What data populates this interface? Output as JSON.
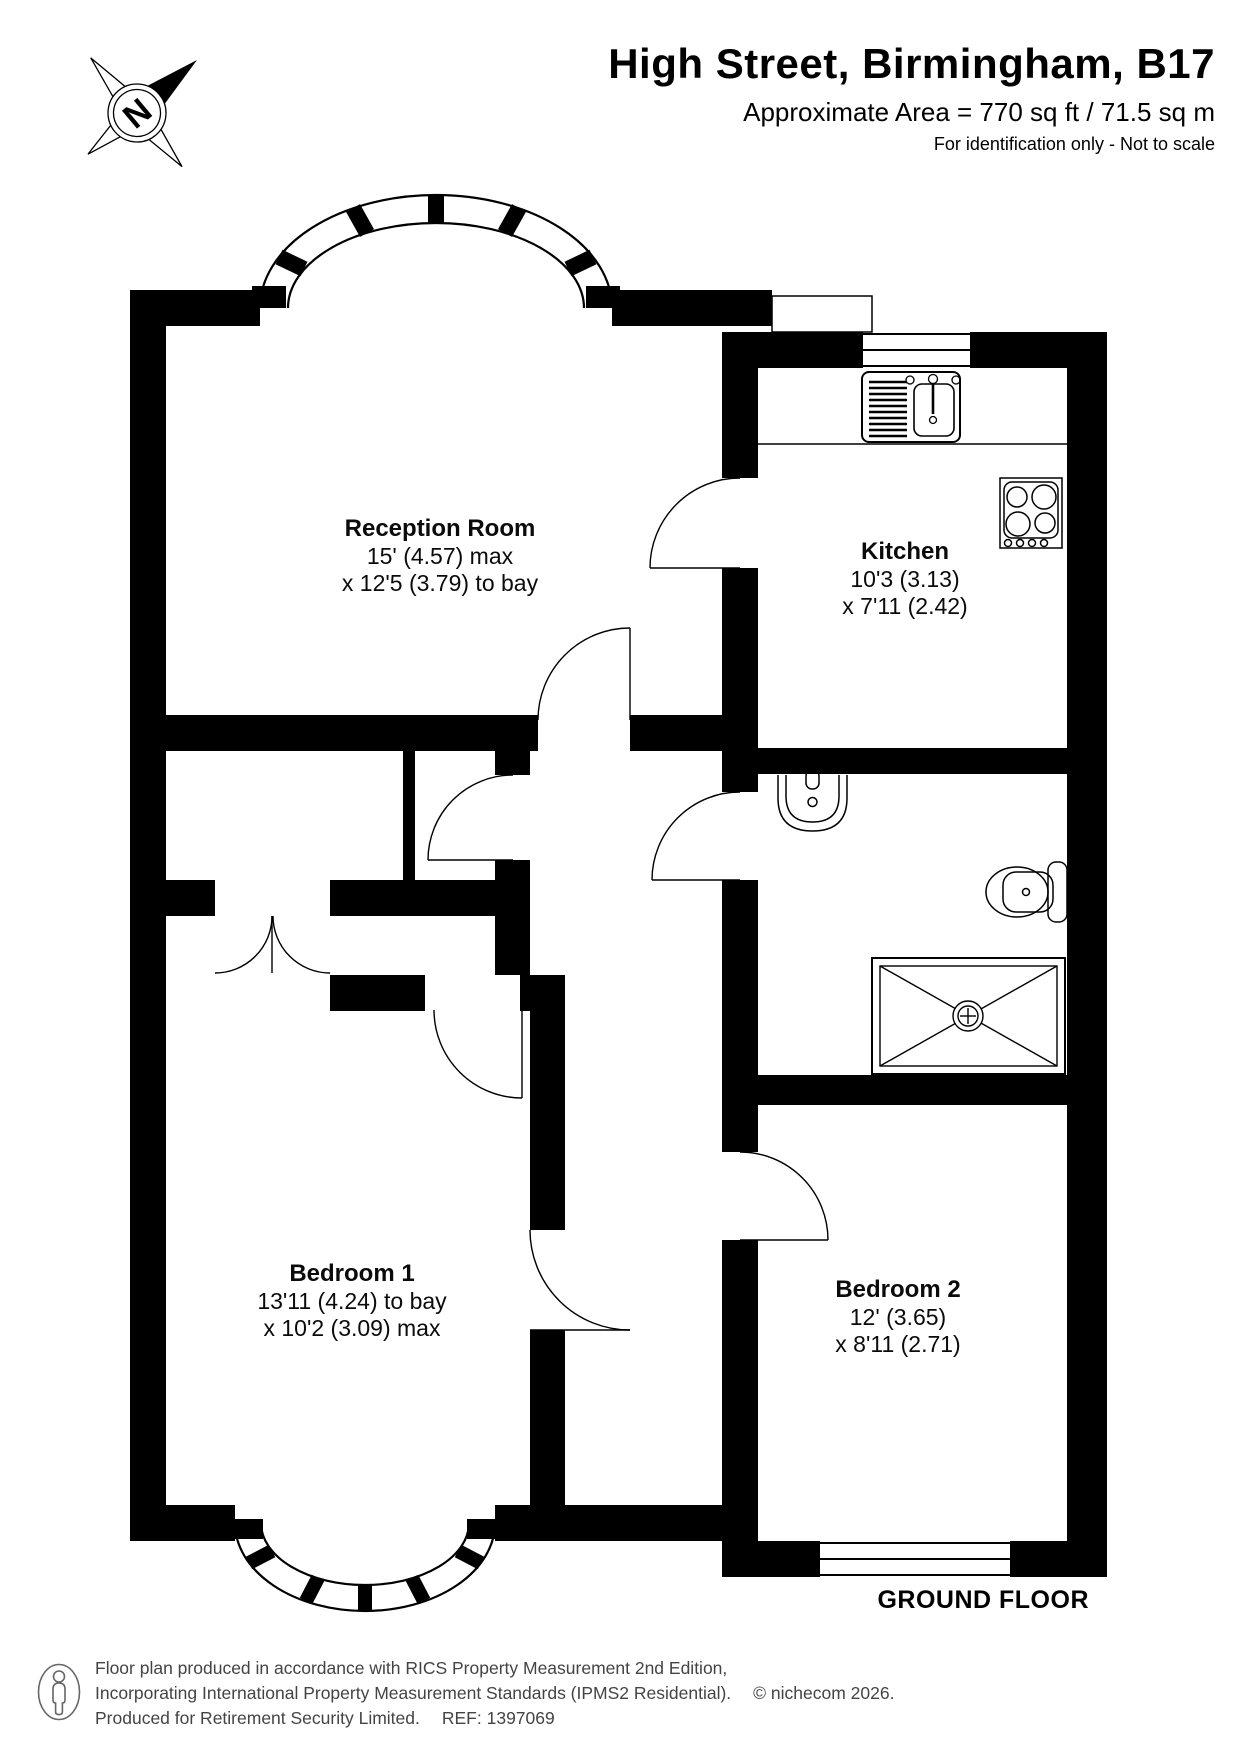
{
  "header": {
    "title": "High Street, Birmingham, B17",
    "subtitle": "Approximate Area = 770 sq ft / 71.5 sq m",
    "disclaimer": "For identification only - Not to scale"
  },
  "compass": {
    "north_label": "N"
  },
  "rooms": {
    "reception": {
      "name": "Reception Room",
      "dim1": "15' (4.57) max",
      "dim2": "x 12'5 (3.79) to bay"
    },
    "kitchen": {
      "name": "Kitchen",
      "dim1": "10'3 (3.13)",
      "dim2": "x 7'11 (2.42)"
    },
    "bedroom1": {
      "name": "Bedroom 1",
      "dim1": "13'11 (4.24) to bay",
      "dim2": "x 10'2 (3.09) max"
    },
    "bedroom2": {
      "name": "Bedroom 2",
      "dim1": "12' (3.65)",
      "dim2": "x 8'11 (2.71)"
    }
  },
  "floor_label": "GROUND FLOOR",
  "footer": {
    "line1": "Floor plan produced in accordance with RICS Property Measurement 2nd Edition,",
    "line2": "Incorporating International Property Measurement Standards (IPMS2 Residential).",
    "copyright": "© nichecom 2026.",
    "line3": "Produced for Retirement Security Limited.",
    "reference": "REF: 1397069"
  },
  "colors": {
    "wall": "#000000",
    "footer_text": "#444444"
  }
}
